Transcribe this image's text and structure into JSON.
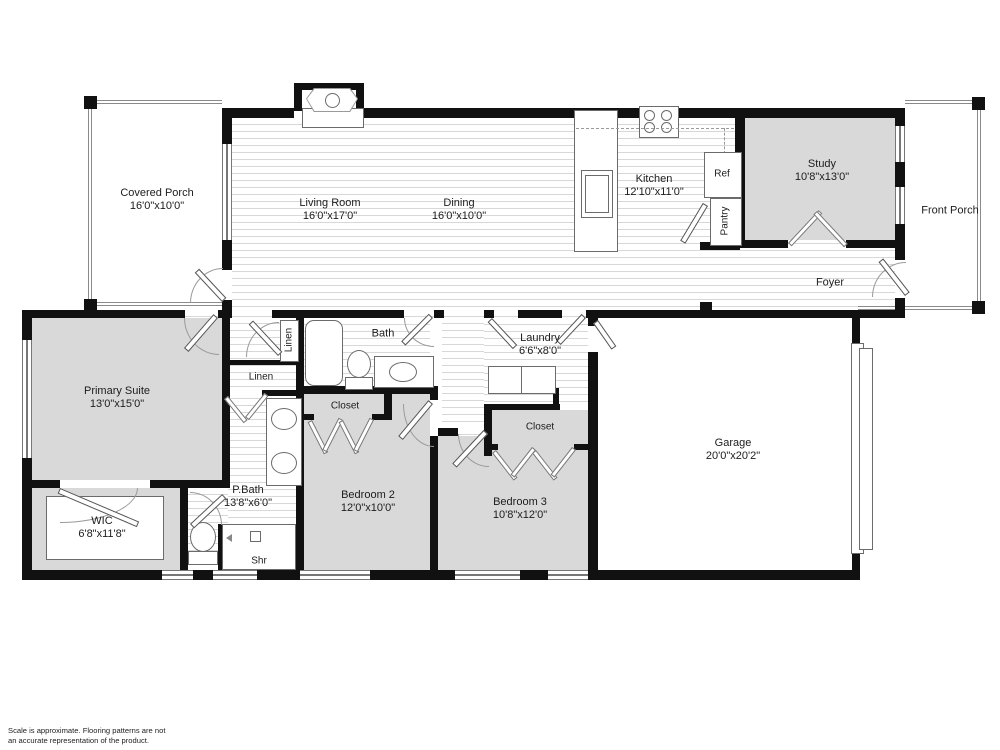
{
  "title": "Single-story house floor plan",
  "rooms": {
    "covered_porch": {
      "name": "Covered Porch",
      "dims": "16'0\"x10'0\""
    },
    "living_room": {
      "name": "Living Room",
      "dims": "16'0\"x17'0\""
    },
    "dining": {
      "name": "Dining",
      "dims": "16'0\"x10'0\""
    },
    "kitchen": {
      "name": "Kitchen",
      "dims": "12'10\"x11'0\""
    },
    "study": {
      "name": "Study",
      "dims": "10'8\"x13'0\""
    },
    "front_porch": {
      "name": "Front Porch"
    },
    "foyer": {
      "name": "Foyer"
    },
    "primary_suite": {
      "name": "Primary Suite",
      "dims": "13'0\"x15'0\""
    },
    "wic": {
      "name": "WIC",
      "dims": "6'8\"x11'8\""
    },
    "p_bath": {
      "name": "P.Bath",
      "dims": "13'8\"x6'0\""
    },
    "bath": {
      "name": "Bath"
    },
    "laundry": {
      "name": "Laundry",
      "dims": "6'6\"x8'0\""
    },
    "bedroom2": {
      "name": "Bedroom 2",
      "dims": "12'0\"x10'0\""
    },
    "bedroom3": {
      "name": "Bedroom 3",
      "dims": "10'8\"x12'0\""
    },
    "garage": {
      "name": "Garage",
      "dims": "20'0\"x20'2\""
    },
    "closet_bed2": {
      "name": "Closet"
    },
    "closet_bed3": {
      "name": "Closet"
    },
    "linen_vertical": {
      "name": "Linen"
    },
    "linen_horizontal": {
      "name": "Linen"
    },
    "shower": {
      "name": "Shr"
    },
    "fridge": {
      "name": "Ref"
    },
    "pantry": {
      "name": "Pantry"
    }
  },
  "footer": {
    "disclaimer": "Scale is approximate. Flooring patterns are not\nan accurate representation of the product."
  },
  "colors": {
    "wall": "#111111",
    "room_fill": "#d9d9d9",
    "floor_stripe": "#d8d8d8",
    "fixture_outline": "#6b6b6b"
  }
}
